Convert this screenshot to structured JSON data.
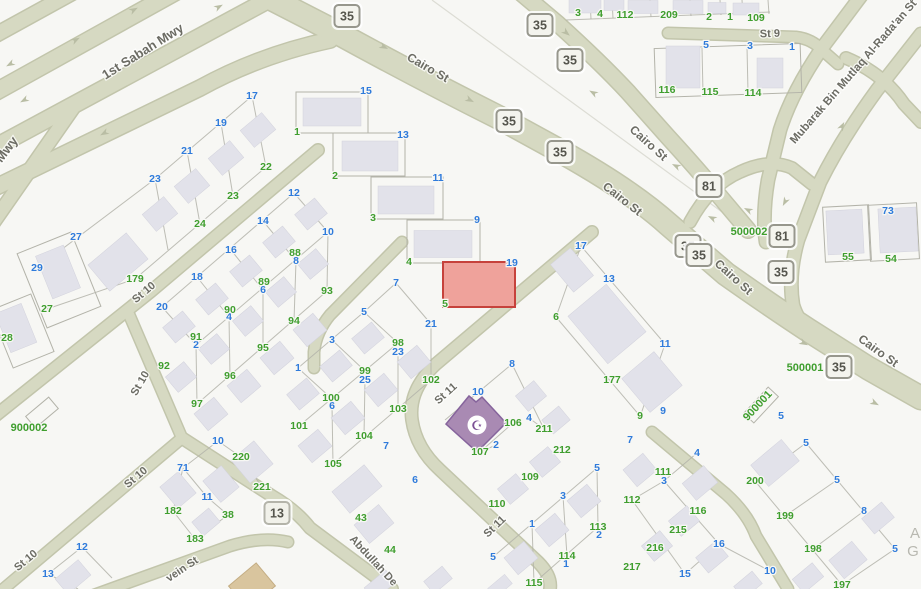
{
  "map": {
    "type": "parcel-map",
    "background_color": "#f7f7f4",
    "road_color": "#d6d9c2",
    "building_color": "#e2e2ea",
    "highlight_parcel": {
      "fill": "#efa29b",
      "stroke": "#c6423c",
      "number_blue": "19",
      "number_green": "5"
    },
    "mosque_parcel": {
      "fill": "#a98ab3",
      "stroke": "#86649c",
      "icon": "mosque-crescent-icon",
      "icon_glyph": "☪"
    }
  },
  "streets": [
    {
      "t": "1st Sabah Mwy",
      "x": 145,
      "y": 55,
      "r": -32,
      "s": 13
    },
    {
      "t": "Mwy",
      "x": 10,
      "y": 152,
      "r": -53,
      "s": 13
    },
    {
      "t": "Cairo St",
      "x": 426,
      "y": 71,
      "r": 30,
      "s": 12
    },
    {
      "t": "Cairo St",
      "x": 646,
      "y": 146,
      "r": 42,
      "s": 12
    },
    {
      "t": "Cairo St",
      "x": 620,
      "y": 202,
      "r": 38,
      "s": 12
    },
    {
      "t": "Cairo St",
      "x": 731,
      "y": 280,
      "r": 42,
      "s": 12
    },
    {
      "t": "Cairo St",
      "x": 876,
      "y": 354,
      "r": 36,
      "s": 12
    },
    {
      "t": "Mubarak Bin Mutlaq Al-Rada'an St",
      "x": 856,
      "y": 74,
      "r": -49,
      "s": 11.5
    },
    {
      "t": "St 9",
      "x": 770,
      "y": 37,
      "r": -2,
      "s": 11
    },
    {
      "t": "St 10",
      "x": 146,
      "y": 295,
      "r": -40,
      "s": 11
    },
    {
      "t": "St 10",
      "x": 143,
      "y": 385,
      "r": -60,
      "s": 11
    },
    {
      "t": "St 10",
      "x": 138,
      "y": 480,
      "r": -40,
      "s": 11
    },
    {
      "t": "St 10",
      "x": 28,
      "y": 563,
      "r": -40,
      "s": 11
    },
    {
      "t": "St 11",
      "x": 448,
      "y": 396,
      "r": -42,
      "s": 11
    },
    {
      "t": "St 11",
      "x": 497,
      "y": 529,
      "r": -44,
      "s": 11
    },
    {
      "t": "Abdullah De",
      "x": 371,
      "y": 563,
      "r": 47,
      "s": 11
    },
    {
      "t": "vein St",
      "x": 184,
      "y": 572,
      "r": -34,
      "s": 11
    }
  ],
  "route_shields": {
    "route_35": {
      "label": "35",
      "positions": [
        [
          347,
          16
        ],
        [
          540,
          25
        ],
        [
          570,
          60
        ],
        [
          509,
          121
        ],
        [
          560,
          152
        ],
        [
          688,
          246
        ],
        [
          699,
          255
        ],
        [
          781,
          272
        ],
        [
          839,
          367
        ]
      ]
    },
    "route_81": {
      "label": "81",
      "positions": [
        [
          709,
          186
        ],
        [
          782,
          236
        ]
      ]
    },
    "route_13": {
      "label": "13",
      "positions": [
        [
          277,
          513
        ]
      ]
    }
  },
  "block_ids": [
    {
      "t": "900002",
      "x": 29,
      "y": 431,
      "r": 0
    },
    {
      "t": "500002",
      "x": 749,
      "y": 235,
      "r": 0
    },
    {
      "t": "500001",
      "x": 805,
      "y": 371,
      "r": 0
    },
    {
      "t": "900001",
      "x": 760,
      "y": 408,
      "r": -47
    }
  ],
  "parcel_numbers": {
    "blue": [
      {
        "t": "5",
        "x": 706,
        "y": 48
      },
      {
        "t": "3",
        "x": 750,
        "y": 49
      },
      {
        "t": "1",
        "x": 792,
        "y": 50
      },
      {
        "t": "73",
        "x": 888,
        "y": 214
      },
      {
        "t": "15",
        "x": 366,
        "y": 94
      },
      {
        "t": "13",
        "x": 403,
        "y": 138
      },
      {
        "t": "11",
        "x": 438,
        "y": 181
      },
      {
        "t": "9",
        "x": 477,
        "y": 223
      },
      {
        "t": "19",
        "x": 512,
        "y": 266
      },
      {
        "t": "17",
        "x": 252,
        "y": 99
      },
      {
        "t": "19",
        "x": 221,
        "y": 126
      },
      {
        "t": "21",
        "x": 187,
        "y": 154
      },
      {
        "t": "23",
        "x": 155,
        "y": 182
      },
      {
        "t": "27",
        "x": 76,
        "y": 240
      },
      {
        "t": "29",
        "x": 37,
        "y": 271
      },
      {
        "t": "12",
        "x": 294,
        "y": 196
      },
      {
        "t": "14",
        "x": 263,
        "y": 224
      },
      {
        "t": "16",
        "x": 231,
        "y": 253
      },
      {
        "t": "18",
        "x": 197,
        "y": 280
      },
      {
        "t": "20",
        "x": 162,
        "y": 310
      },
      {
        "t": "10",
        "x": 328,
        "y": 235
      },
      {
        "t": "8",
        "x": 296,
        "y": 264
      },
      {
        "t": "6",
        "x": 263,
        "y": 293
      },
      {
        "t": "4",
        "x": 229,
        "y": 320
      },
      {
        "t": "2",
        "x": 196,
        "y": 348
      },
      {
        "t": "1",
        "x": 298,
        "y": 371
      },
      {
        "t": "7",
        "x": 396,
        "y": 286
      },
      {
        "t": "5",
        "x": 364,
        "y": 315
      },
      {
        "t": "3",
        "x": 332,
        "y": 343
      },
      {
        "t": "21",
        "x": 431,
        "y": 327
      },
      {
        "t": "23",
        "x": 398,
        "y": 355
      },
      {
        "t": "25",
        "x": 365,
        "y": 383
      },
      {
        "t": "6",
        "x": 332,
        "y": 409
      },
      {
        "t": "7",
        "x": 386,
        "y": 449
      },
      {
        "t": "17",
        "x": 581,
        "y": 249
      },
      {
        "t": "13",
        "x": 609,
        "y": 282
      },
      {
        "t": "11",
        "x": 665,
        "y": 347
      },
      {
        "t": "9",
        "x": 663,
        "y": 414
      },
      {
        "t": "8",
        "x": 512,
        "y": 367
      },
      {
        "t": "10",
        "x": 478,
        "y": 395
      },
      {
        "t": "4",
        "x": 529,
        "y": 421
      },
      {
        "t": "2",
        "x": 496,
        "y": 448
      },
      {
        "t": "6",
        "x": 415,
        "y": 483
      },
      {
        "t": "5",
        "x": 597,
        "y": 471
      },
      {
        "t": "3",
        "x": 563,
        "y": 499
      },
      {
        "t": "1",
        "x": 532,
        "y": 527
      },
      {
        "t": "5",
        "x": 493,
        "y": 560
      },
      {
        "t": "2",
        "x": 599,
        "y": 538
      },
      {
        "t": "1",
        "x": 566,
        "y": 567
      },
      {
        "t": "7",
        "x": 630,
        "y": 443
      },
      {
        "t": "4",
        "x": 697,
        "y": 456
      },
      {
        "t": "3",
        "x": 664,
        "y": 484
      },
      {
        "t": "16",
        "x": 719,
        "y": 547
      },
      {
        "t": "15",
        "x": 685,
        "y": 577
      },
      {
        "t": "10",
        "x": 770,
        "y": 574
      },
      {
        "t": "5",
        "x": 781,
        "y": 419
      },
      {
        "t": "5",
        "x": 806,
        "y": 446
      },
      {
        "t": "5",
        "x": 837,
        "y": 483
      },
      {
        "t": "8",
        "x": 864,
        "y": 514
      },
      {
        "t": "5",
        "x": 895,
        "y": 552
      },
      {
        "t": "10",
        "x": 218,
        "y": 444
      },
      {
        "t": "71",
        "x": 183,
        "y": 471
      },
      {
        "t": "11",
        "x": 207,
        "y": 500
      },
      {
        "t": "12",
        "x": 82,
        "y": 550
      },
      {
        "t": "13",
        "x": 48,
        "y": 577
      }
    ],
    "green": [
      {
        "t": "3",
        "x": 578,
        "y": 16
      },
      {
        "t": "4",
        "x": 600,
        "y": 17
      },
      {
        "t": "112",
        "x": 625,
        "y": 18
      },
      {
        "t": "209",
        "x": 669,
        "y": 18
      },
      {
        "t": "2",
        "x": 709,
        "y": 20
      },
      {
        "t": "1",
        "x": 730,
        "y": 20
      },
      {
        "t": "109",
        "x": 756,
        "y": 21
      },
      {
        "t": "116",
        "x": 667,
        "y": 93
      },
      {
        "t": "115",
        "x": 710,
        "y": 95
      },
      {
        "t": "114",
        "x": 753,
        "y": 96
      },
      {
        "t": "55",
        "x": 848,
        "y": 260
      },
      {
        "t": "54",
        "x": 891,
        "y": 262
      },
      {
        "t": "1",
        "x": 297,
        "y": 135
      },
      {
        "t": "2",
        "x": 335,
        "y": 179
      },
      {
        "t": "3",
        "x": 373,
        "y": 221
      },
      {
        "t": "4",
        "x": 409,
        "y": 265
      },
      {
        "t": "5",
        "x": 445,
        "y": 307
      },
      {
        "t": "22",
        "x": 266,
        "y": 170
      },
      {
        "t": "23",
        "x": 233,
        "y": 199
      },
      {
        "t": "24",
        "x": 200,
        "y": 227
      },
      {
        "t": "179",
        "x": 135,
        "y": 282
      },
      {
        "t": "27",
        "x": 47,
        "y": 312
      },
      {
        "t": "28",
        "x": 7,
        "y": 341
      },
      {
        "t": "88",
        "x": 295,
        "y": 256
      },
      {
        "t": "89",
        "x": 264,
        "y": 285
      },
      {
        "t": "90",
        "x": 230,
        "y": 313
      },
      {
        "t": "91",
        "x": 196,
        "y": 340
      },
      {
        "t": "92",
        "x": 164,
        "y": 369
      },
      {
        "t": "93",
        "x": 327,
        "y": 294
      },
      {
        "t": "94",
        "x": 294,
        "y": 324
      },
      {
        "t": "95",
        "x": 263,
        "y": 351
      },
      {
        "t": "96",
        "x": 230,
        "y": 379
      },
      {
        "t": "97",
        "x": 197,
        "y": 407
      },
      {
        "t": "98",
        "x": 398,
        "y": 346
      },
      {
        "t": "99",
        "x": 365,
        "y": 374
      },
      {
        "t": "100",
        "x": 331,
        "y": 401
      },
      {
        "t": "101",
        "x": 299,
        "y": 429
      },
      {
        "t": "102",
        "x": 431,
        "y": 383
      },
      {
        "t": "103",
        "x": 398,
        "y": 412
      },
      {
        "t": "104",
        "x": 364,
        "y": 439
      },
      {
        "t": "105",
        "x": 333,
        "y": 467
      },
      {
        "t": "6",
        "x": 556,
        "y": 320
      },
      {
        "t": "177",
        "x": 612,
        "y": 383
      },
      {
        "t": "9",
        "x": 640,
        "y": 419
      },
      {
        "t": "106",
        "x": 513,
        "y": 426
      },
      {
        "t": "211",
        "x": 544,
        "y": 432
      },
      {
        "t": "107",
        "x": 480,
        "y": 455
      },
      {
        "t": "212",
        "x": 562,
        "y": 453
      },
      {
        "t": "109",
        "x": 530,
        "y": 480
      },
      {
        "t": "110",
        "x": 497,
        "y": 507
      },
      {
        "t": "113",
        "x": 598,
        "y": 530
      },
      {
        "t": "114",
        "x": 567,
        "y": 559
      },
      {
        "t": "115",
        "x": 534,
        "y": 586
      },
      {
        "t": "43",
        "x": 361,
        "y": 521
      },
      {
        "t": "44",
        "x": 390,
        "y": 553
      },
      {
        "t": "111",
        "x": 663,
        "y": 475
      },
      {
        "t": "112",
        "x": 632,
        "y": 503
      },
      {
        "t": "116",
        "x": 698,
        "y": 514
      },
      {
        "t": "215",
        "x": 678,
        "y": 533
      },
      {
        "t": "216",
        "x": 655,
        "y": 551
      },
      {
        "t": "217",
        "x": 632,
        "y": 570
      },
      {
        "t": "200",
        "x": 755,
        "y": 484
      },
      {
        "t": "199",
        "x": 785,
        "y": 519
      },
      {
        "t": "198",
        "x": 813,
        "y": 552
      },
      {
        "t": "197",
        "x": 842,
        "y": 588
      },
      {
        "t": "220",
        "x": 241,
        "y": 460
      },
      {
        "t": "221",
        "x": 262,
        "y": 490
      },
      {
        "t": "182",
        "x": 173,
        "y": 514
      },
      {
        "t": "38",
        "x": 228,
        "y": 518
      },
      {
        "t": "183",
        "x": 195,
        "y": 542
      }
    ]
  },
  "partial_labels": [
    {
      "t": "A",
      "x": 915,
      "y": 538
    },
    {
      "t": "G",
      "x": 913,
      "y": 556
    }
  ]
}
